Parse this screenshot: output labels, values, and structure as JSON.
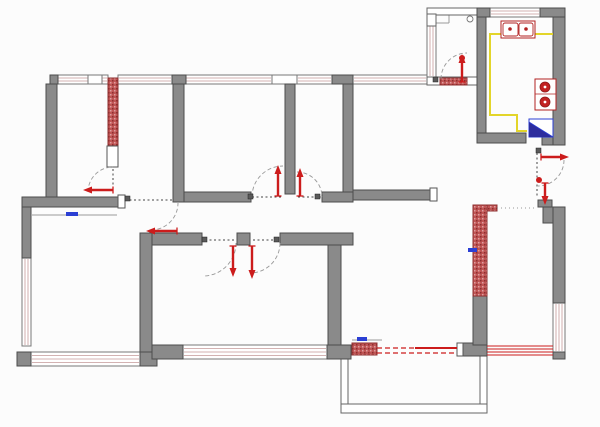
{
  "meta": {
    "type": "architectural-floor-plan",
    "canvas_width": 600,
    "canvas_height": 427,
    "background": "#fcfcfc"
  },
  "palette": {
    "wall_gray": "#8a8a8a",
    "wall_stroke": "#4c4c4c",
    "red": "#cc1c1c",
    "red_wall": "#c05555",
    "red_wall_dark": "#8e2f2f",
    "window_stripe": "#c49898",
    "window_stroke": "#777777",
    "thin_stroke": "#666666",
    "dash_dark": "#444444",
    "arc_gray": "#999999",
    "yellow": "#e3d52a",
    "blue": "#2b3fd4",
    "navy": "#2d2d9e",
    "guide": "#9a9a9a",
    "hinge": "#5a5a5a"
  },
  "walls": [
    [
      50,
      75,
      8,
      9
    ],
    [
      172,
      75,
      14,
      9
    ],
    [
      332,
      75,
      21,
      9
    ],
    [
      46,
      84,
      11,
      114
    ],
    [
      173,
      84,
      11,
      118
    ],
    [
      285,
      84,
      10,
      110
    ],
    [
      343,
      84,
      10,
      108
    ],
    [
      22,
      197,
      98,
      10
    ],
    [
      22,
      207,
      9,
      51
    ],
    [
      17,
      352,
      14,
      14
    ],
    [
      140,
      345,
      17,
      21
    ],
    [
      184,
      192,
      67,
      10
    ],
    [
      322,
      192,
      31,
      10
    ],
    [
      353,
      190,
      77,
      10
    ],
    [
      140,
      233,
      12,
      119
    ],
    [
      152,
      233,
      50,
      12
    ],
    [
      237,
      233,
      13,
      12
    ],
    [
      280,
      233,
      73,
      12
    ],
    [
      328,
      245,
      13,
      107
    ],
    [
      152,
      345,
      31,
      14
    ],
    [
      327,
      345,
      24,
      14
    ],
    [
      460,
      343,
      27,
      13
    ],
    [
      477,
      8,
      13,
      9
    ],
    [
      540,
      8,
      25,
      9
    ],
    [
      477,
      17,
      9,
      116
    ],
    [
      477,
      133,
      49,
      10
    ],
    [
      542,
      133,
      23,
      12
    ],
    [
      553,
      17,
      12,
      128
    ],
    [
      538,
      200,
      14,
      7
    ],
    [
      543,
      207,
      22,
      16
    ],
    [
      553,
      207,
      12,
      96
    ],
    [
      553,
      352,
      12,
      7
    ],
    [
      473,
      296,
      14,
      49
    ]
  ],
  "red_walls": [
    [
      108,
      78,
      10,
      69
    ],
    [
      473,
      205,
      14,
      91
    ],
    [
      487,
      205,
      10,
      6
    ],
    [
      352,
      343,
      25,
      12
    ],
    [
      440,
      78,
      27,
      7
    ]
  ],
  "windows": [
    {
      "r": [
        57,
        75,
        51,
        9
      ],
      "dir": "h"
    },
    {
      "r": [
        118,
        75,
        54,
        9
      ],
      "dir": "h"
    },
    {
      "r": [
        185,
        75,
        87,
        9
      ],
      "dir": "h"
    },
    {
      "r": [
        297,
        75,
        35,
        9
      ],
      "dir": "h"
    },
    {
      "r": [
        353,
        75,
        74,
        9
      ],
      "dir": "h"
    },
    {
      "r": [
        490,
        8,
        50,
        9
      ],
      "dir": "h"
    },
    {
      "r": [
        427,
        25,
        9,
        52
      ],
      "dir": "v"
    },
    {
      "r": [
        22,
        258,
        9,
        88
      ],
      "dir": "v"
    },
    {
      "r": [
        31,
        352,
        109,
        14
      ],
      "dir": "h"
    },
    {
      "r": [
        183,
        345,
        144,
        14
      ],
      "dir": "h"
    },
    {
      "r": [
        553,
        303,
        12,
        49
      ],
      "dir": "v"
    },
    {
      "r": [
        358,
        405,
        105,
        8
      ],
      "dir": "h"
    }
  ],
  "window_frames": [
    [
      88,
      75,
      14,
      9
    ],
    [
      272,
      75,
      25,
      9
    ]
  ],
  "thin_walls": [
    [
      427,
      8,
      50,
      7
    ],
    [
      427,
      14,
      9,
      12
    ],
    [
      427,
      77,
      50,
      8
    ],
    [
      341,
      352,
      7,
      58
    ],
    [
      480,
      352,
      7,
      58
    ],
    [
      341,
      404,
      146,
      9
    ]
  ],
  "jambs": [
    [
      118,
      195,
      7,
      13
    ],
    [
      430,
      188,
      7,
      13
    ],
    [
      457,
      343,
      6,
      13
    ],
    [
      107,
      146,
      11,
      21
    ]
  ],
  "thresholds": [
    [
      125,
      200,
      172,
      200
    ],
    [
      252,
      197,
      282,
      197
    ],
    [
      298,
      197,
      321,
      197
    ],
    [
      205,
      240,
      234,
      240
    ],
    [
      253,
      240,
      278,
      240
    ],
    [
      537,
      153,
      537,
      196
    ],
    [
      113,
      169,
      113,
      189
    ]
  ],
  "dotted_lines": [
    [
      497,
      208,
      534,
      208
    ]
  ],
  "door_arcs": [
    "M 88 192 A 25 25 0 0 1 113 167",
    "M 151 230 A 27 27 0 0 0 178 203",
    "M 252 197 A 31 31 0 0 1 283 166",
    "M 297 172 A 25 25 0 0 1 322 197",
    "M 236 243 A 33 33 0 0 1 203 276",
    "M 280 243 A 30 30 0 0 1 250 273",
    "M 441 79 A 26 26 0 0 1 467 53",
    "M 564 160 A 26 26 0 0 1 538 186"
  ],
  "red_dashed": [
    [
      377,
      348,
      415,
      348
    ],
    [
      377,
      353,
      457,
      353
    ]
  ],
  "red_lines": [
    [
      415,
      348,
      457,
      348,
      2
    ],
    [
      487,
      346,
      553,
      346,
      1
    ],
    [
      487,
      349,
      553,
      349,
      1
    ],
    [
      487,
      352,
      553,
      352,
      1
    ],
    [
      487,
      355,
      553,
      355,
      1
    ]
  ],
  "arrows": [
    {
      "name": "bedroom-a-door-arrow",
      "x1": 113,
      "y1": 190,
      "x2": 88,
      "y2": 190
    },
    {
      "name": "living-room-entry-arrow",
      "x1": 177,
      "y1": 231,
      "x2": 151,
      "y2": 231
    },
    {
      "name": "room-c-door-arrow",
      "x1": 278,
      "y1": 196,
      "x2": 278,
      "y2": 170
    },
    {
      "name": "room-d-door-arrow",
      "x1": 300,
      "y1": 196,
      "x2": 300,
      "y2": 173
    },
    {
      "name": "room-f-door-arrow",
      "x1": 233,
      "y1": 246,
      "x2": 233,
      "y2": 272
    },
    {
      "name": "room-g-door-arrow",
      "x1": 252,
      "y1": 246,
      "x2": 252,
      "y2": 274
    },
    {
      "name": "balcony-door-arrow",
      "x1": 462,
      "y1": 82,
      "x2": 462,
      "y2": 59
    },
    {
      "name": "corridor-east-arrow",
      "x1": 541,
      "y1": 157,
      "x2": 564,
      "y2": 157
    },
    {
      "name": "corridor-south-arrow",
      "x1": 545,
      "y1": 183,
      "x2": 545,
      "y2": 200
    }
  ],
  "hinges": [
    [
      248,
      194
    ],
    [
      315,
      194
    ],
    [
      202,
      237
    ],
    [
      274,
      237
    ],
    [
      433,
      77
    ],
    [
      125,
      196
    ],
    [
      536,
      148
    ]
  ],
  "blue_markers": [
    [
      66,
      212,
      12,
      4
    ],
    [
      357,
      337,
      10,
      4
    ],
    [
      468,
      248,
      9,
      4
    ]
  ],
  "guide_lines": [
    [
      32,
      215,
      117,
      215
    ],
    [
      352,
      340,
      382,
      340
    ],
    [
      428,
      23,
      449,
      23
    ],
    [
      449,
      14,
      449,
      23
    ]
  ],
  "circles": [
    {
      "cx": 470,
      "cy": 19,
      "r": 3,
      "fill": "#ffffff",
      "stroke": "#777777",
      "name": "balcony-symbol-circle"
    },
    {
      "cx": 539,
      "cy": 180,
      "r": 3,
      "fill": "#cc1c1c",
      "stroke": "none",
      "name": "corridor-door-knob"
    },
    {
      "cx": 462,
      "cy": 58,
      "r": 3,
      "fill": "#cc1c1c",
      "stroke": "none",
      "name": "balcony-arrow-cap"
    }
  ],
  "fixtures": {
    "sink": {
      "outer": [
        501,
        21,
        34,
        17
      ],
      "basins": [
        [
          503,
          23,
          15,
          13
        ],
        [
          519,
          23,
          14,
          13
        ]
      ],
      "taps": [
        [
          510,
          29
        ],
        [
          526,
          29
        ]
      ]
    },
    "stove": {
      "outer": [
        535,
        79,
        21,
        31
      ],
      "divider_y": 94,
      "burners": [
        [
          545,
          87
        ],
        [
          545,
          102
        ]
      ],
      "burner_r": 5
    },
    "fridge": {
      "rect": [
        529,
        119,
        24,
        18
      ],
      "triangle": [
        [
          529,
          137
        ],
        [
          553,
          137
        ],
        [
          529,
          122
        ]
      ],
      "diag": [
        529,
        122,
        553,
        137
      ]
    },
    "counter_points": "553,34 490,34 490,115 517,115 517,131 527,131"
  }
}
